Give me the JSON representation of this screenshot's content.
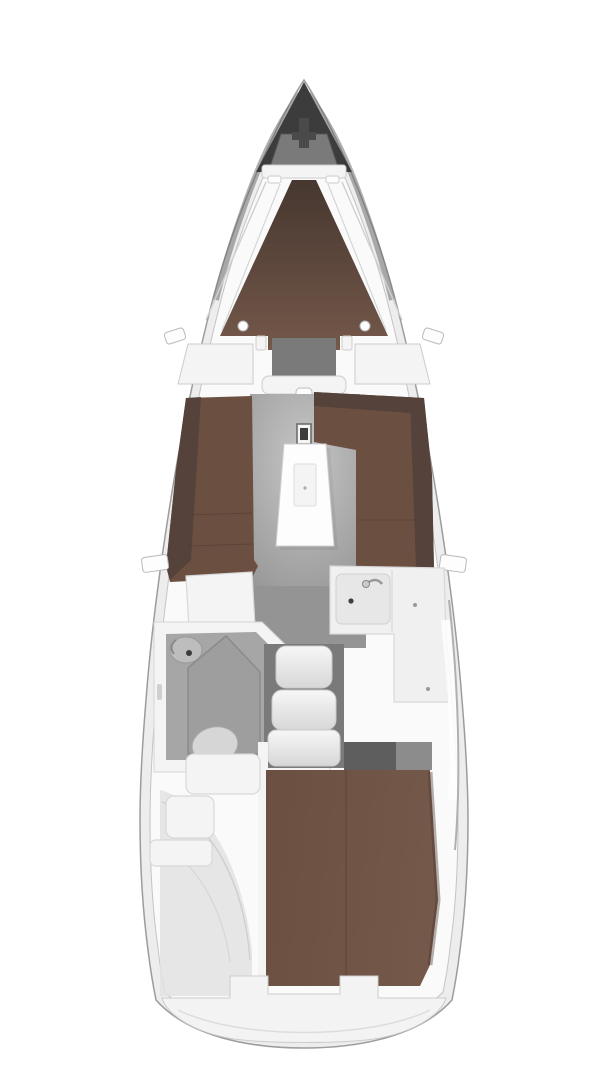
{
  "figure": {
    "kind": "sailboat-interior-floorplan",
    "view": "top-down",
    "regions": [
      "bow-anchor-locker",
      "forward-cabin-v-berth",
      "saloon",
      "port-settee",
      "starboard-settee",
      "saloon-table",
      "mast-post",
      "nav-table",
      "galley",
      "wet-head",
      "wash-basin",
      "toilet",
      "companionway-steps",
      "aft-cabin-berth",
      "stern-locker",
      "transom"
    ]
  },
  "colors": {
    "canvas": "#ffffff",
    "hull_fill": "#ededed",
    "hull_stroke": "#9c9c9c",
    "deck_fill": "#fafafa",
    "deck_stroke": "#c4c4c4",
    "hull_shade": "#6f6f6f",
    "bow_dark": "#3c3c3c",
    "anchor_well": "#7a7a7a",
    "windlass": "#4a4a4a",
    "cushion_dark": "#46372f",
    "cushion": "#6b5042",
    "cushion_light": "#74584a",
    "backrest": "#55423a",
    "floor": "#949494",
    "floor_light": "#c6c6c6",
    "floor_dark": "#7a7a7a",
    "entrance_floor": "#5e5e5e",
    "shelf_gray": "#8c8c8c",
    "furniture": "#f4f4f4",
    "bright_white": "#fdfdfd",
    "head_floor": "#a6a6a6",
    "shower_pan": "#9e9e9e",
    "basin": "#bdbdbd",
    "toilet_bowl": "#d6d6d6",
    "counter": "#f0f0f0",
    "sink": "#e7e7e7",
    "knob_dark": "#3f3f3f",
    "step_top": "#f7f7f7",
    "step_bottom": "#d7d7d7",
    "transom_fill": "#f3f3f3",
    "locker_shade": "#e2e2e2"
  }
}
